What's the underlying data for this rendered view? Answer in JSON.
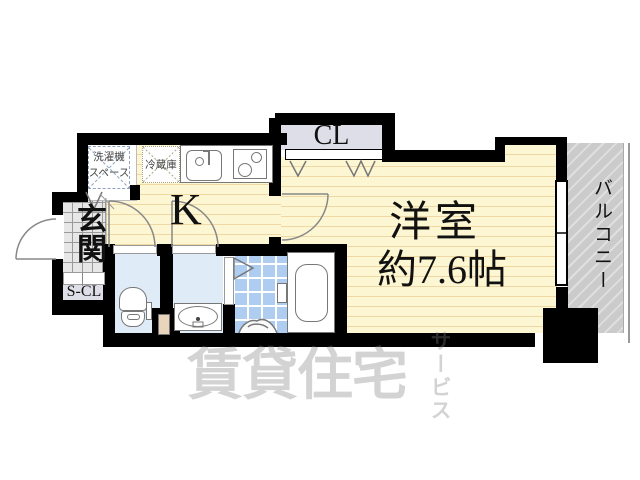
{
  "floorplan": {
    "labels": {
      "kitchen": "K",
      "closet": "CL",
      "entrance": "玄関",
      "shoe_closet": "S-CL",
      "western_room": "洋室",
      "western_room_size": "約7.6帖",
      "balcony": "バルコニー",
      "washer_space_line1": "洗濯機",
      "washer_space_line2": "スペース",
      "refrigerator": "冷蔵庫"
    },
    "watermark": {
      "main": "賃貸住宅",
      "sub": "サービス"
    },
    "colors": {
      "wall": "#000000",
      "room_floor": "#fdf6d3",
      "room_stripe": "#f0d8a4",
      "closet_fill": "#dedee8",
      "sanitary_fill": "#dfecf8",
      "bath_tile": "#aecdf0",
      "balcony_fill": "#cbcbcb",
      "entrance_tile": "#e7e7e7",
      "door_leaf": "#e8d5bc",
      "watermark_gray": "#7d7d7d"
    },
    "icons": [
      "kitchen-sink-icon",
      "stove-icon",
      "washer-space-cross-icon",
      "refrigerator-cross-icon",
      "toilet-icon",
      "washbasin-icon",
      "bathtub-icon",
      "folding-door-icon",
      "door-swing-arc-icon",
      "closet-bifold-zigzag-icon",
      "window-icon",
      "balcony-railing-icon"
    ]
  }
}
